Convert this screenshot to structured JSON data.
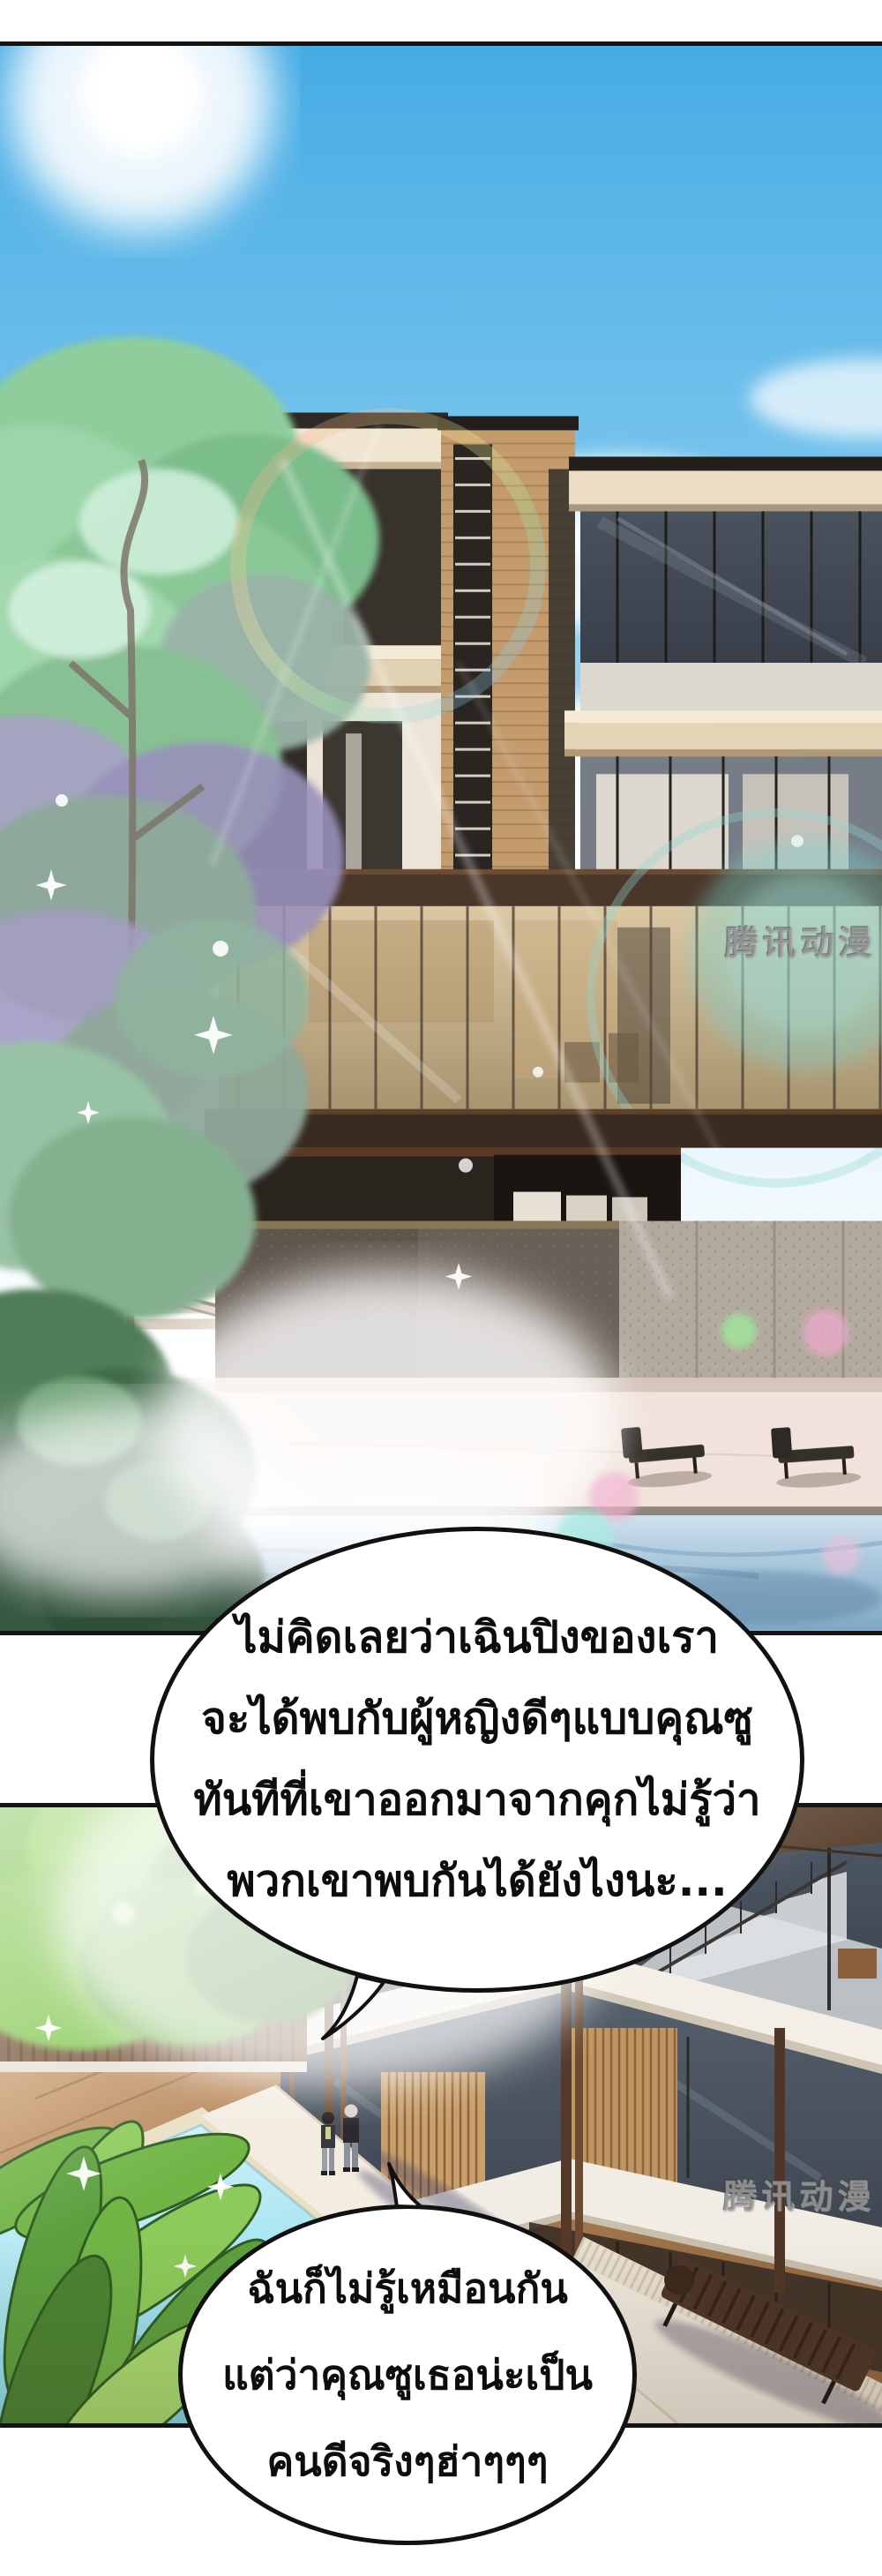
{
  "comic": {
    "bubble1": {
      "lines": [
        "ไม่คิดเลยว่าเฉินปิงของเรา",
        "จะได้พบกับผู้หญิงดีๆแบบคุณซู",
        "ทันทีที่เขาออกมาจากคุกไม่รู้ว่า",
        "พวกเขาพบกันได้ยังไงนะ..."
      ]
    },
    "bubble2": {
      "lines": [
        "ฉันก็ไม่รู้เหมือนกัน",
        "แต่ว่าคุณซูเธอน่ะเป็น",
        "คนดีจริงๆฮ่าๆๆๆ"
      ]
    },
    "watermark": "腾讯动漫",
    "colors": {
      "page_bg": "#ffffff",
      "panel_border": "#141414",
      "sky_top": "#46ace4",
      "sky_haze": "#e8f5fc",
      "cloud": "#ffffff",
      "tree_green": "#8fce9c",
      "tree_lavender": "#a49cc2",
      "bush_dark": "#3f6a4a",
      "villa_wood": "#c39b6d",
      "roof_cream": "#efe5d0",
      "glass_dark": "#3e4651",
      "glass_warm": "#c4ad85",
      "espresso_beam": "#4a372a",
      "granite": "#b3aa9f",
      "terrace": "#f1e3db",
      "pool_panel1": "#a9c8dc",
      "flare_teal": "#7fd2cc",
      "deck_wood": "#b08256",
      "pool_panel2": "#7cd6e8",
      "plant_green": "#71b547",
      "beam_white": "#f3efe7",
      "speech_text": "#0d0d0d"
    }
  }
}
